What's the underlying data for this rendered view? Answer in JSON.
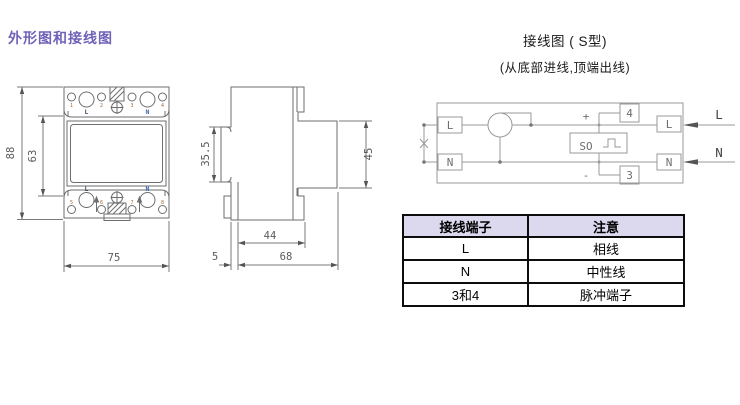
{
  "page": {
    "title": "外形图和接线图"
  },
  "wiring_header": {
    "title": "接线图 ( S型)",
    "subtitle": "(从底部进线,顶端出线)"
  },
  "front_view": {
    "dim_height": "88",
    "dim_window_height": "63",
    "dim_width": "75",
    "top": {
      "n1": "1",
      "n2": "2",
      "n3": "3",
      "n4": "4",
      "l": "L",
      "n": "N"
    },
    "bottom": {
      "n5": "5",
      "n6": "6",
      "n7": "7",
      "n8": "8",
      "l": "L",
      "n": "N"
    }
  },
  "side_view": {
    "dim_rail_slot": "35.5",
    "dim_front_height": "45",
    "dim_base_depth": "44",
    "dim_clip": "5",
    "dim_total_depth": "68"
  },
  "wiring": {
    "box_l_in": "L",
    "box_n_in": "N",
    "box_l_out": "L",
    "box_n_out": "N",
    "label_l_out": "L",
    "label_n_out": "N",
    "so": "SO",
    "plus": "+",
    "minus": "-",
    "terminal_4": "4",
    "terminal_3": "3"
  },
  "table": {
    "headers": [
      "接线端子",
      "注意"
    ],
    "rows": [
      {
        "terminal": "L",
        "note": "相线"
      },
      {
        "terminal": "N",
        "note": "中性线"
      },
      {
        "terminal": "3和4",
        "note": "脉冲端子"
      }
    ]
  },
  "colors": {
    "accent": "#6f62b8",
    "table_header_bg": "#dcd8ee",
    "drawing_line": "#6e6e6e"
  }
}
